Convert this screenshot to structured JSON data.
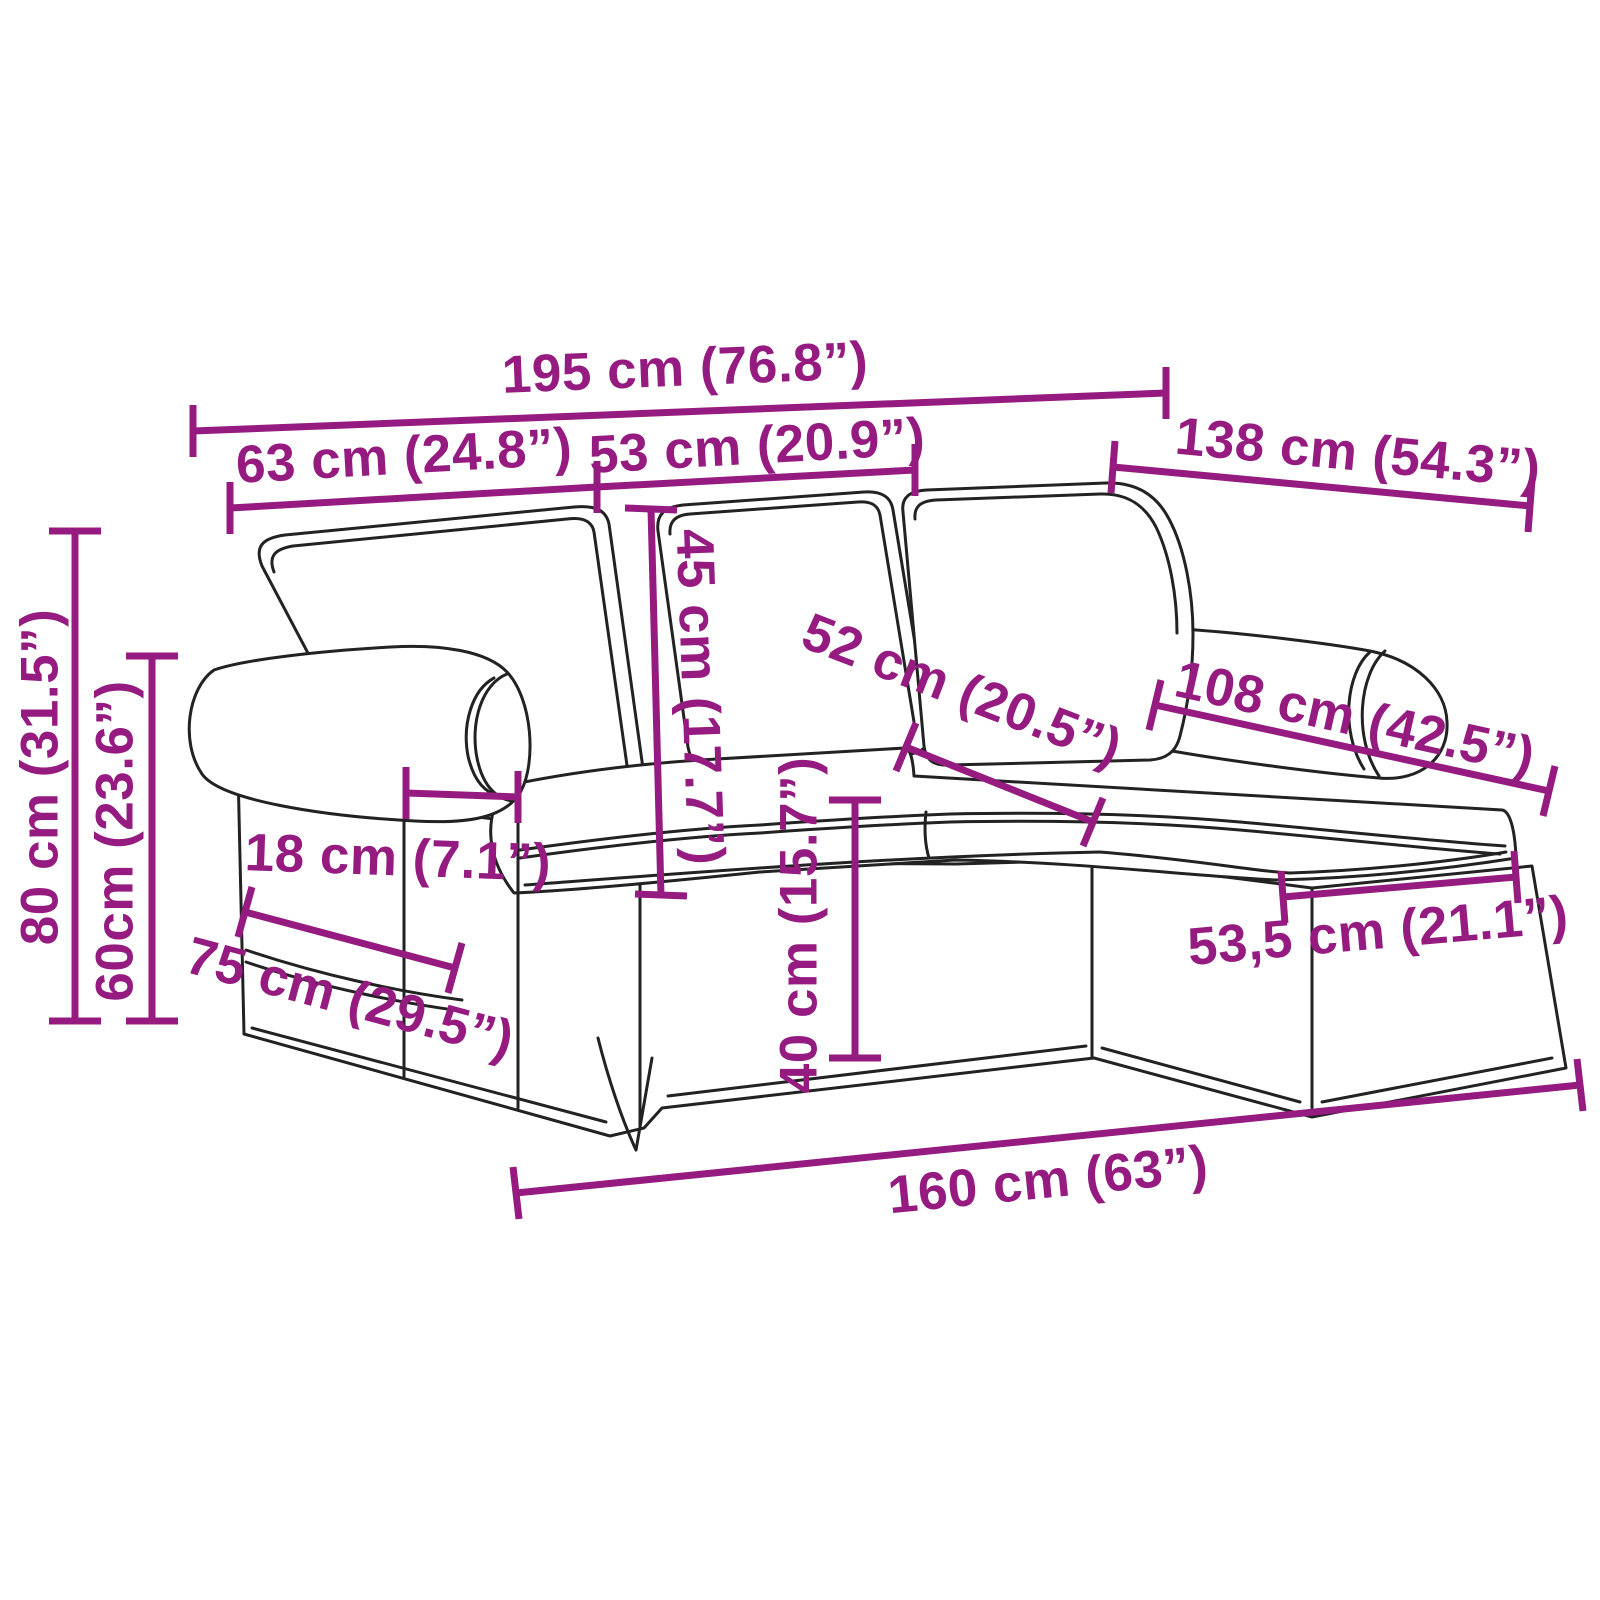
{
  "figure": {
    "kind": "furniture dimension diagram",
    "subject": "3-seater sofa with chaise longue, outline line drawing with measurements",
    "units": [
      "cm",
      "inches"
    ],
    "accent_color": "#951B81",
    "drawing_color": "#222222",
    "background_color": "#FFFFFF"
  },
  "dimensions": {
    "overall_width": "195 cm (76.8”)",
    "left_section_width": "63 cm (24.8”)",
    "middle_section_width": "53 cm (20.9”)",
    "depth_with_chaise": "138 cm (54.3”)",
    "back_cushion_height": "45 cm (17.7”)",
    "seat_depth": "52 cm (20.5”)",
    "chaise_cushion_length": "108 cm (42.5”)",
    "overall_height": "80 cm (31.5”)",
    "arm_height": "60cm (23.6”)",
    "armrest_width": "18 cm (7.1”)",
    "base_depth": "75 cm (29.5”)",
    "seat_height": "40 cm (15.7”)",
    "chaise_width": "53,5 cm (21.1”)",
    "base_front_length": "160 cm (63”)"
  }
}
